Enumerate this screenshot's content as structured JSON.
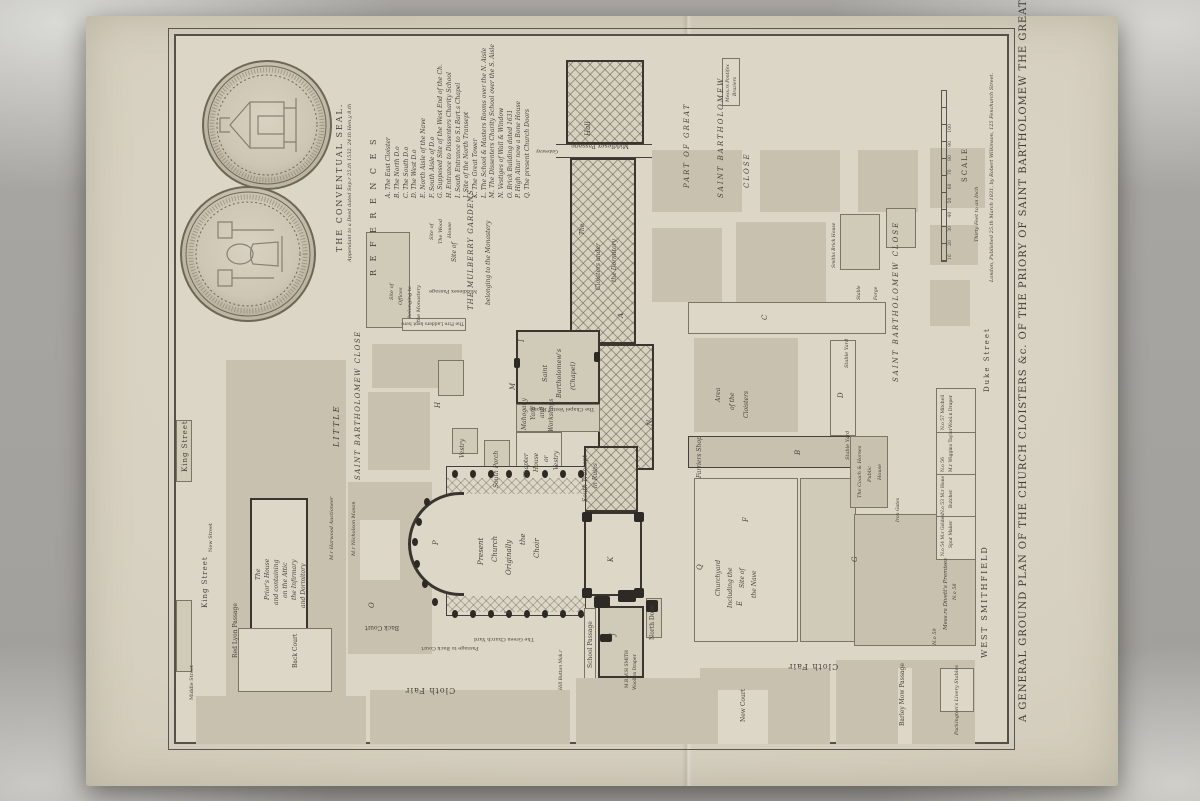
{
  "title": "A GENERAL GROUND PLAN OF THE CHURCH CLOISTERS &c. OF THE PRIORY OF SAINT BARTHOLOMEW THE GREAT.",
  "imprint": "London, Published 25.th March 1831, by Robert Wilkinson, 125 Fenchurch Street.",
  "seal": {
    "caption": "THE CONVENTUAL SEAL.",
    "subcaption": "Appendant to a Deed dated Sep.r 25.th 1532. 24.th Hen.y 8.th"
  },
  "references": {
    "heading": "R E F E R E N C E S",
    "items": [
      "A. The East Cloister",
      "B. The North D.o",
      "C. The South D.o",
      "D. The West D.o",
      "E. North Aisle of the Nave",
      "F. South Aisle of D.o",
      "G. Supposed Site of the West End of the Ch.",
      "H. Entrance to Dissenters Charity School",
      "I. South Entrance to S.t Bart.s Chapel",
      "J. Site of the North Transept",
      "K. The Great Tower",
      "L. The School & Masters Rooms over the N. Aisle",
      "M. The Dissenters Charity School over the S. Aisle",
      "N. Vestiges of Wall & Window",
      "O. Brick Building dated 1631",
      "P. High Altar now a Bone House",
      "Q. The present Church Doors"
    ]
  },
  "scale": {
    "label": "SCALE",
    "note": "Thirty Feet to an Inch",
    "ticks": "10 20 30 40 50 60 70 80 90 100"
  },
  "streets": {
    "king_street_1": "King Street",
    "king_street_2": "King Street",
    "new_street": "New Street",
    "middle_street": "Middle Street",
    "red_lyon": "Red Lyon Passage",
    "back_court_1": "Back Court",
    "back_court_2": "Back Court",
    "passage_back_court": "Passage to Back Court",
    "green_churchyard": "The Green Church Yard",
    "cloth_fair_1": "Cloth Fair",
    "cloth_fair_2": "Cloth Fair",
    "new_court": "New Court",
    "barley_mow": "Barley Mow Passage",
    "duke_street": "Duke Street",
    "west_smithfield": "WEST SMITHFIELD",
    "middlesex_passage_1": "Middlesex Passage",
    "middlesex_passage_2": "Middlesex Passage",
    "school_passage": "School Passage",
    "north_door": "North Door",
    "gateway": "Gateway"
  },
  "areas": {
    "little": "LITTLE",
    "st_barts_close_w": "SAINT BARTHOLOMEW CLOSE",
    "part_of_great": "PART OF GREAT",
    "st_bartholomew": "SAINT BARTHOLOMEW",
    "close": "CLOSE",
    "st_barts_close_e": "SAINT BARTHOLOMEW CLOSE",
    "hall": "Hall",
    "fire_ladders": "The Fire Ladders kept here"
  },
  "labels": {
    "corridor": [
      "The",
      "Cloisters under",
      "the Dormitory"
    ],
    "mulberry": [
      "Site of",
      "THE MULBERRY GARDENS",
      "belonging to the Monastery"
    ],
    "offices": [
      "Site of",
      "Offices",
      "belonging to",
      "the Monastery"
    ],
    "wood_house": [
      "Site of",
      "The Wood",
      "House"
    ],
    "priors_house": [
      "The",
      "Prior's House",
      "and containing",
      "on the Attic",
      "the Infirmary",
      "and Dormitory"
    ],
    "present_church": [
      "Present",
      "Church",
      "Originally",
      "the",
      "Choir"
    ],
    "south_porch": "South Porch",
    "vestry": "Vestry",
    "chapter_house": [
      "Chapter",
      "House",
      "or",
      "Vestry"
    ],
    "mahogany": [
      "Mahogany",
      "Yard",
      "and",
      "Workshops"
    ],
    "south_transept": [
      "South Transept",
      "in Ruins"
    ],
    "chapel": [
      "Saint",
      "Bartholomew's",
      "(Chapel)"
    ],
    "chapel_vestry": "The Chapel Vestry Rooms",
    "churchyard": [
      "Churchyard",
      "Including the",
      "Site of",
      "the Nave"
    ],
    "area_cloisters": [
      "Area",
      "of the",
      "Cloisters"
    ],
    "farriers": "Farriers Shop",
    "coach_horses": [
      "The Coach & Horses",
      "Public",
      "House"
    ],
    "stable_yard_1": "Stable Yard",
    "stable_yard_2": "Stable Yard",
    "iron_gates": "Iron Gates",
    "divett": [
      "Mess.rs Divett's Premises",
      "N.o 58",
      "N.o 59"
    ],
    "smith": [
      "M.R W.H SMITH",
      "Woollen Draper"
    ],
    "hill": "Hill Button Mak.r",
    "harwood": "M.r Harwood Auctioneer",
    "nicholson": "M.r Nicholson Mason",
    "braziers": [
      "Mess.rs Pontifex",
      "Braziers"
    ],
    "smiths_brick": "Smiths Brick House",
    "stable": "Stable",
    "forge": "Forge",
    "packington": "Packington's Livery Stables"
  },
  "shops": {
    "s1": [
      "N.o 57 Mitchell",
      "Wool.n Draper"
    ],
    "s2": [
      "N.o 56",
      "M.r Wiggins Taylor"
    ],
    "s3": [
      "N.o 53 M.r Hone",
      "Butcher"
    ],
    "s4": [
      "N.o 54 M.r Golden",
      "Spur Maker"
    ]
  },
  "letters": {
    "a": "A",
    "b": "B",
    "c": "C",
    "d": "D",
    "e": "E",
    "f": "F",
    "g": "G",
    "h": "H",
    "i": "I",
    "j": "J",
    "k": "K",
    "l": "L",
    "m": "M",
    "n": "N",
    "o": "O",
    "p": "P",
    "q": "Q"
  }
}
